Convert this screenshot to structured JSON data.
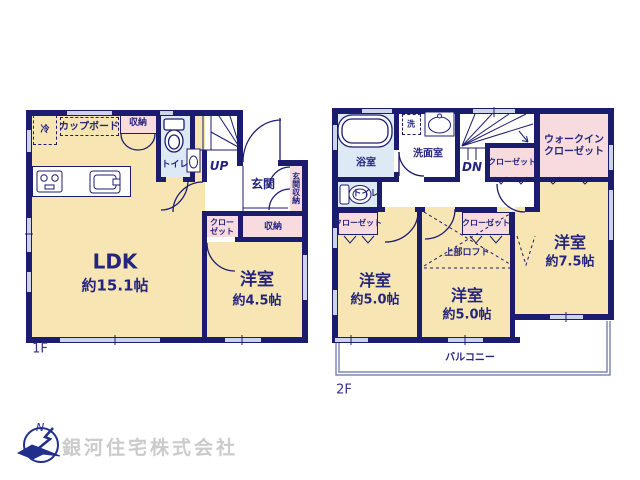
{
  "colors": {
    "wall": "#1c1c6e",
    "room_cream": "#f7e6b4",
    "closet_pink": "#f8dbde",
    "wet_blue": "#ddeaf6",
    "window_fill": "#cdd3ea",
    "text_navy": "#25257d",
    "watermark_gray": "#cbcbcb"
  },
  "floor1": {
    "label": "1F",
    "ldk": {
      "name": "LDK",
      "size": "約15.1帖"
    },
    "bedroom": {
      "name": "洋室",
      "size": "約4.5帖"
    },
    "toilet": "トイレ",
    "stairs": "UP",
    "entrance": "玄関",
    "entrance_storage": "玄関収納",
    "storage_top": "収納",
    "storage": "収納",
    "closet_line1": "クロー",
    "closet_line2": "ゼット",
    "fridge": "冷",
    "cupboard": "カップボード"
  },
  "floor2": {
    "label": "2F",
    "bath": "浴室",
    "laundry": "洗",
    "washroom": "洗面室",
    "stairs": "DN",
    "toilet": "トイレ",
    "closet_stairs": "クローゼット",
    "wic_line1": "ウォークイン",
    "wic_line2": "クローゼット",
    "closet_left": "クローゼット",
    "closet_mid": "クローゼット",
    "loft": "上部ロフト",
    "bedroom_left": {
      "name": "洋室",
      "size": "約5.0帖"
    },
    "bedroom_mid": {
      "name": "洋室",
      "size": "約5.0帖"
    },
    "bedroom_right": {
      "name": "洋室",
      "size": "約7.5帖"
    },
    "balcony": "バルコニー"
  },
  "footer": {
    "company": "銀河住宅株式会社",
    "compass_north": "N"
  }
}
